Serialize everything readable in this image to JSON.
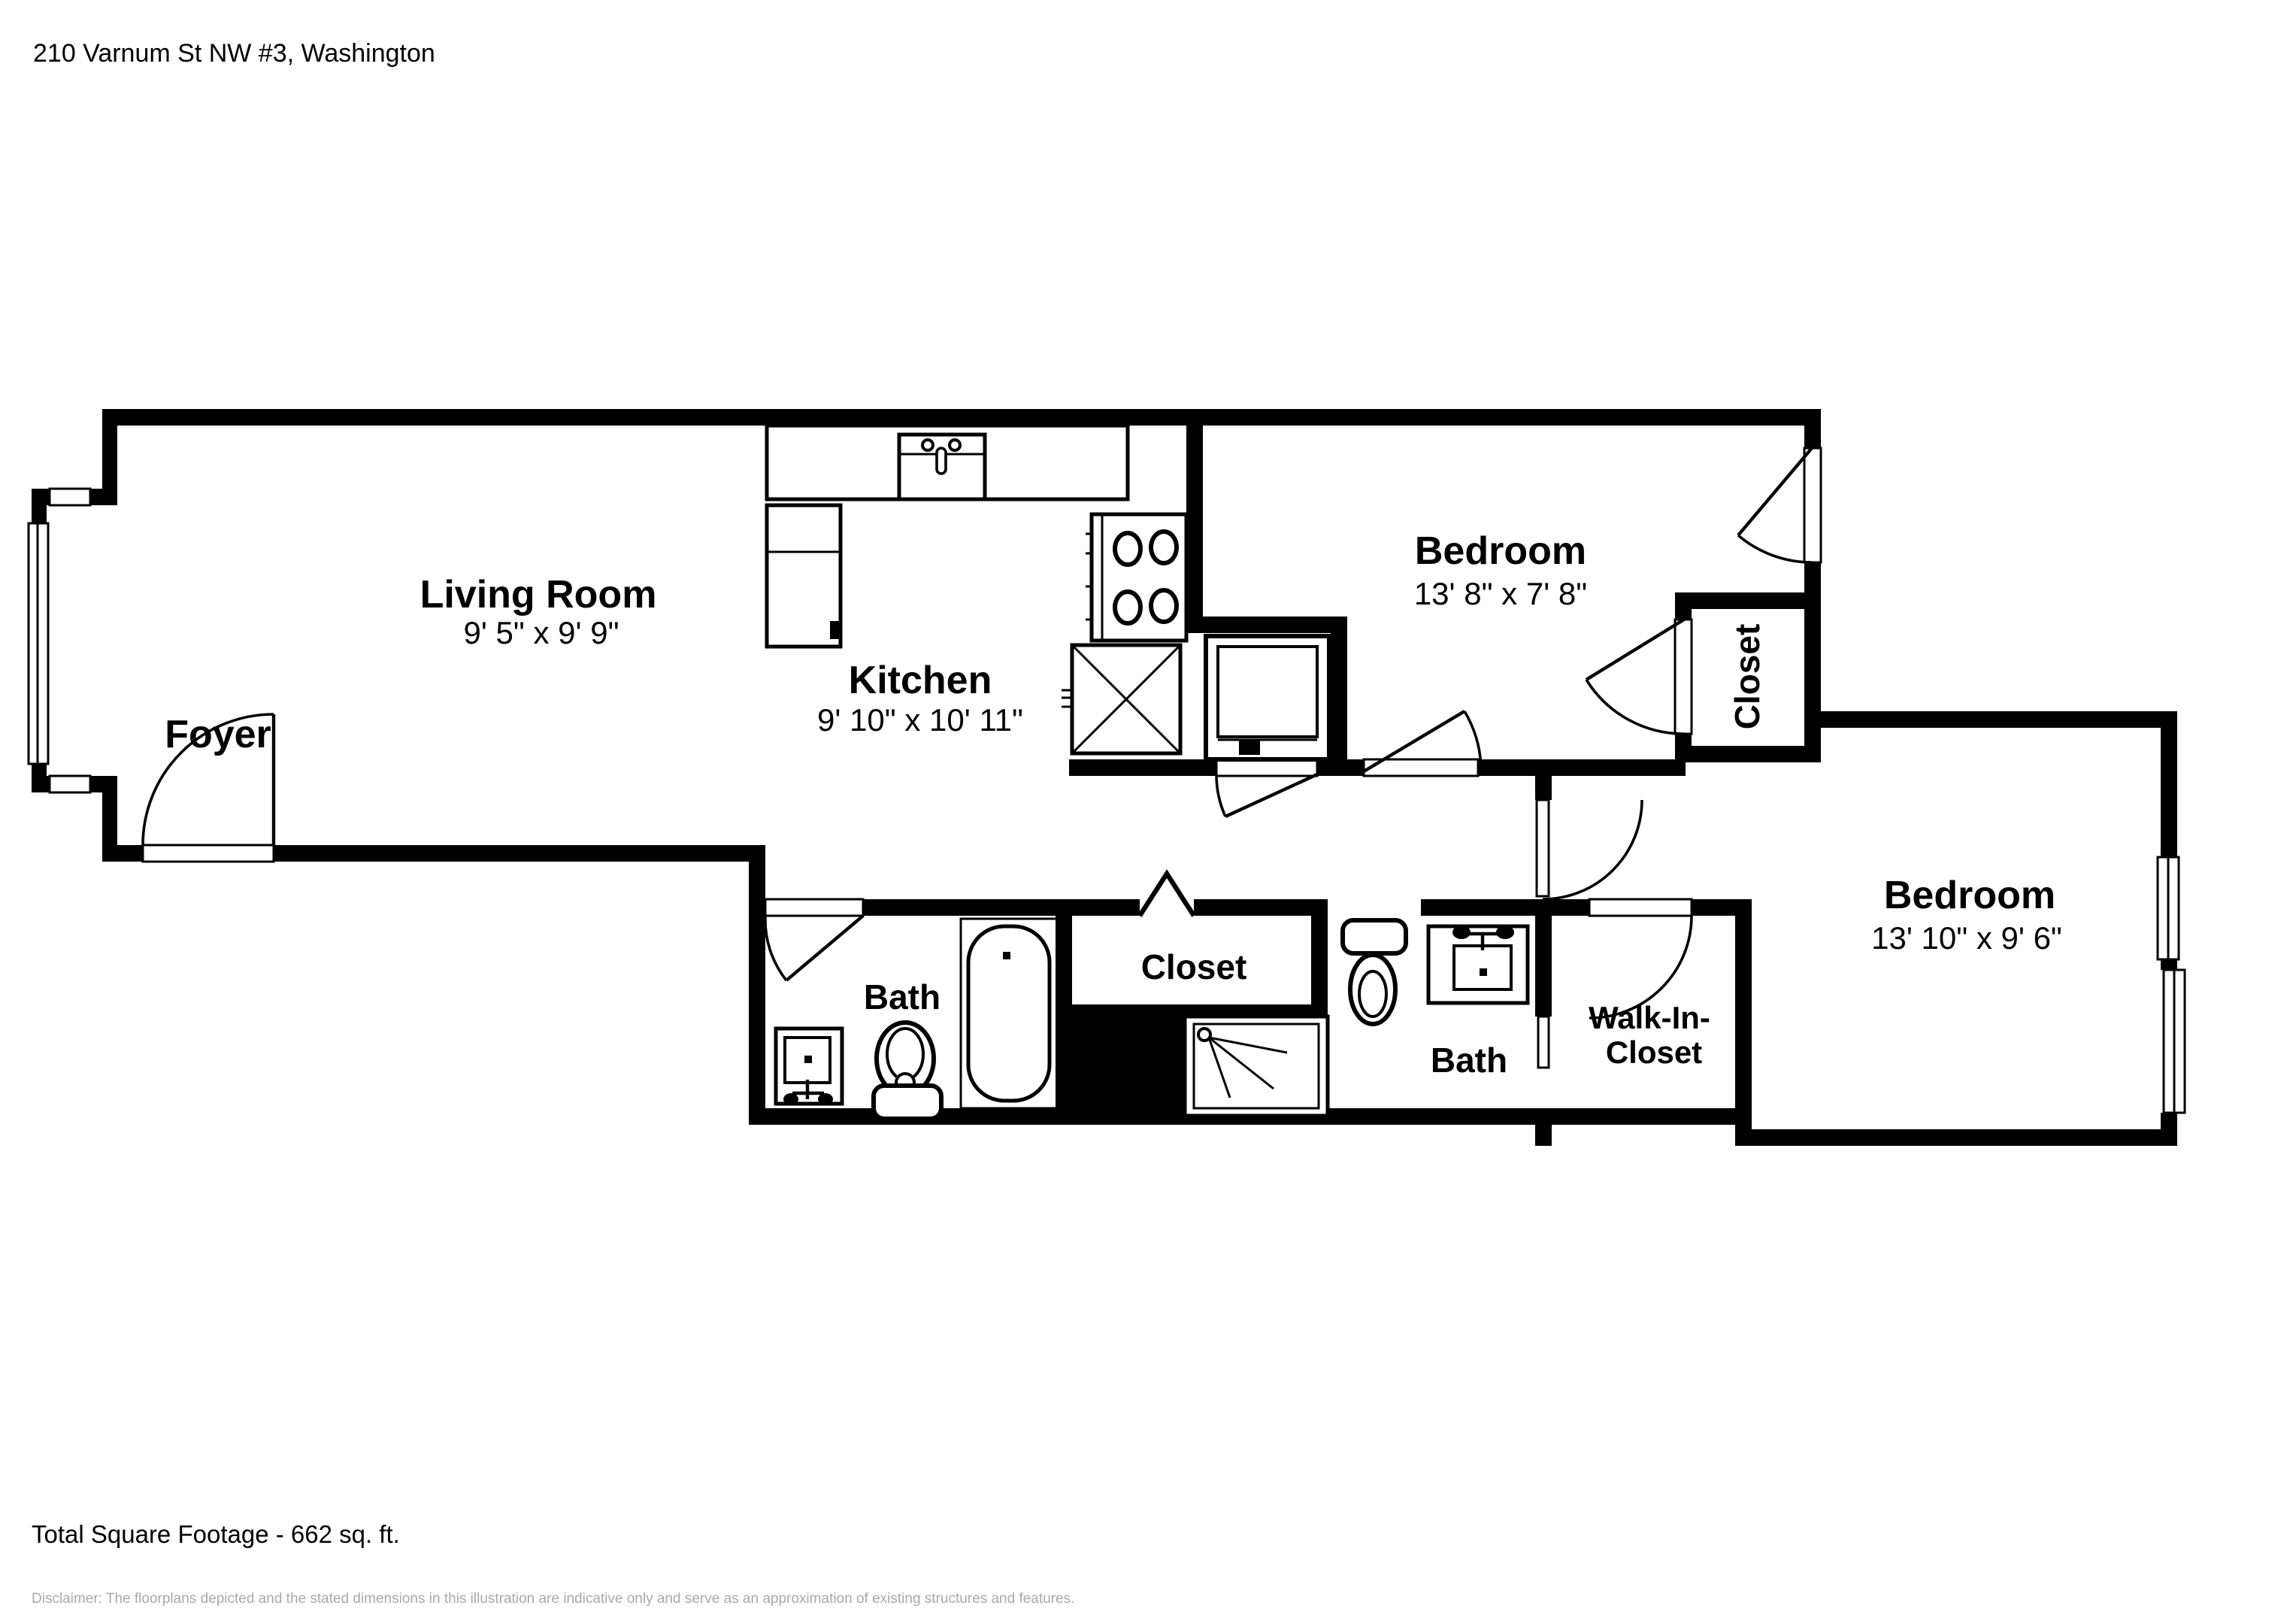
{
  "page": {
    "background": "#ffffff",
    "ink": "#000000",
    "muted_text_color": "#a4aab4"
  },
  "header": {
    "address": "210 Varnum St NW #3, Washington"
  },
  "floorplan": {
    "rooms": {
      "living_room": {
        "label": "Living Room",
        "dimensions": "9' 5\" x 9' 9\""
      },
      "foyer": {
        "label": "Foyer"
      },
      "kitchen": {
        "label": "Kitchen",
        "dimensions": "9' 10\" x 10' 11\""
      },
      "bedroom_top": {
        "label": "Bedroom",
        "dimensions": "13' 8\" x 7' 8\""
      },
      "closet_bedroom_top": {
        "label": "Closet"
      },
      "bedroom_right": {
        "label": "Bedroom",
        "dimensions": "13' 10\" x 9' 6\""
      },
      "bath_left": {
        "label": "Bath"
      },
      "hall_closet": {
        "label": "Closet"
      },
      "bath_right": {
        "label": "Bath"
      },
      "walk_in_closet": {
        "label_line1": "Walk-In-",
        "label_line2": "Closet"
      }
    }
  },
  "footer": {
    "total_square_footage": "Total Square Footage - 662 sq. ft.",
    "disclaimer_line1": "Disclaimer: The floorplans depicted and the stated dimensions in this illustration are indicative only and serve as an approximation of existing structures and features.",
    "disclaimer_line2": "This illustration is not guaranteed to be accurate or complete. The accuracy of all information should be verified through personal inspection and/or with appropriate professionals."
  }
}
